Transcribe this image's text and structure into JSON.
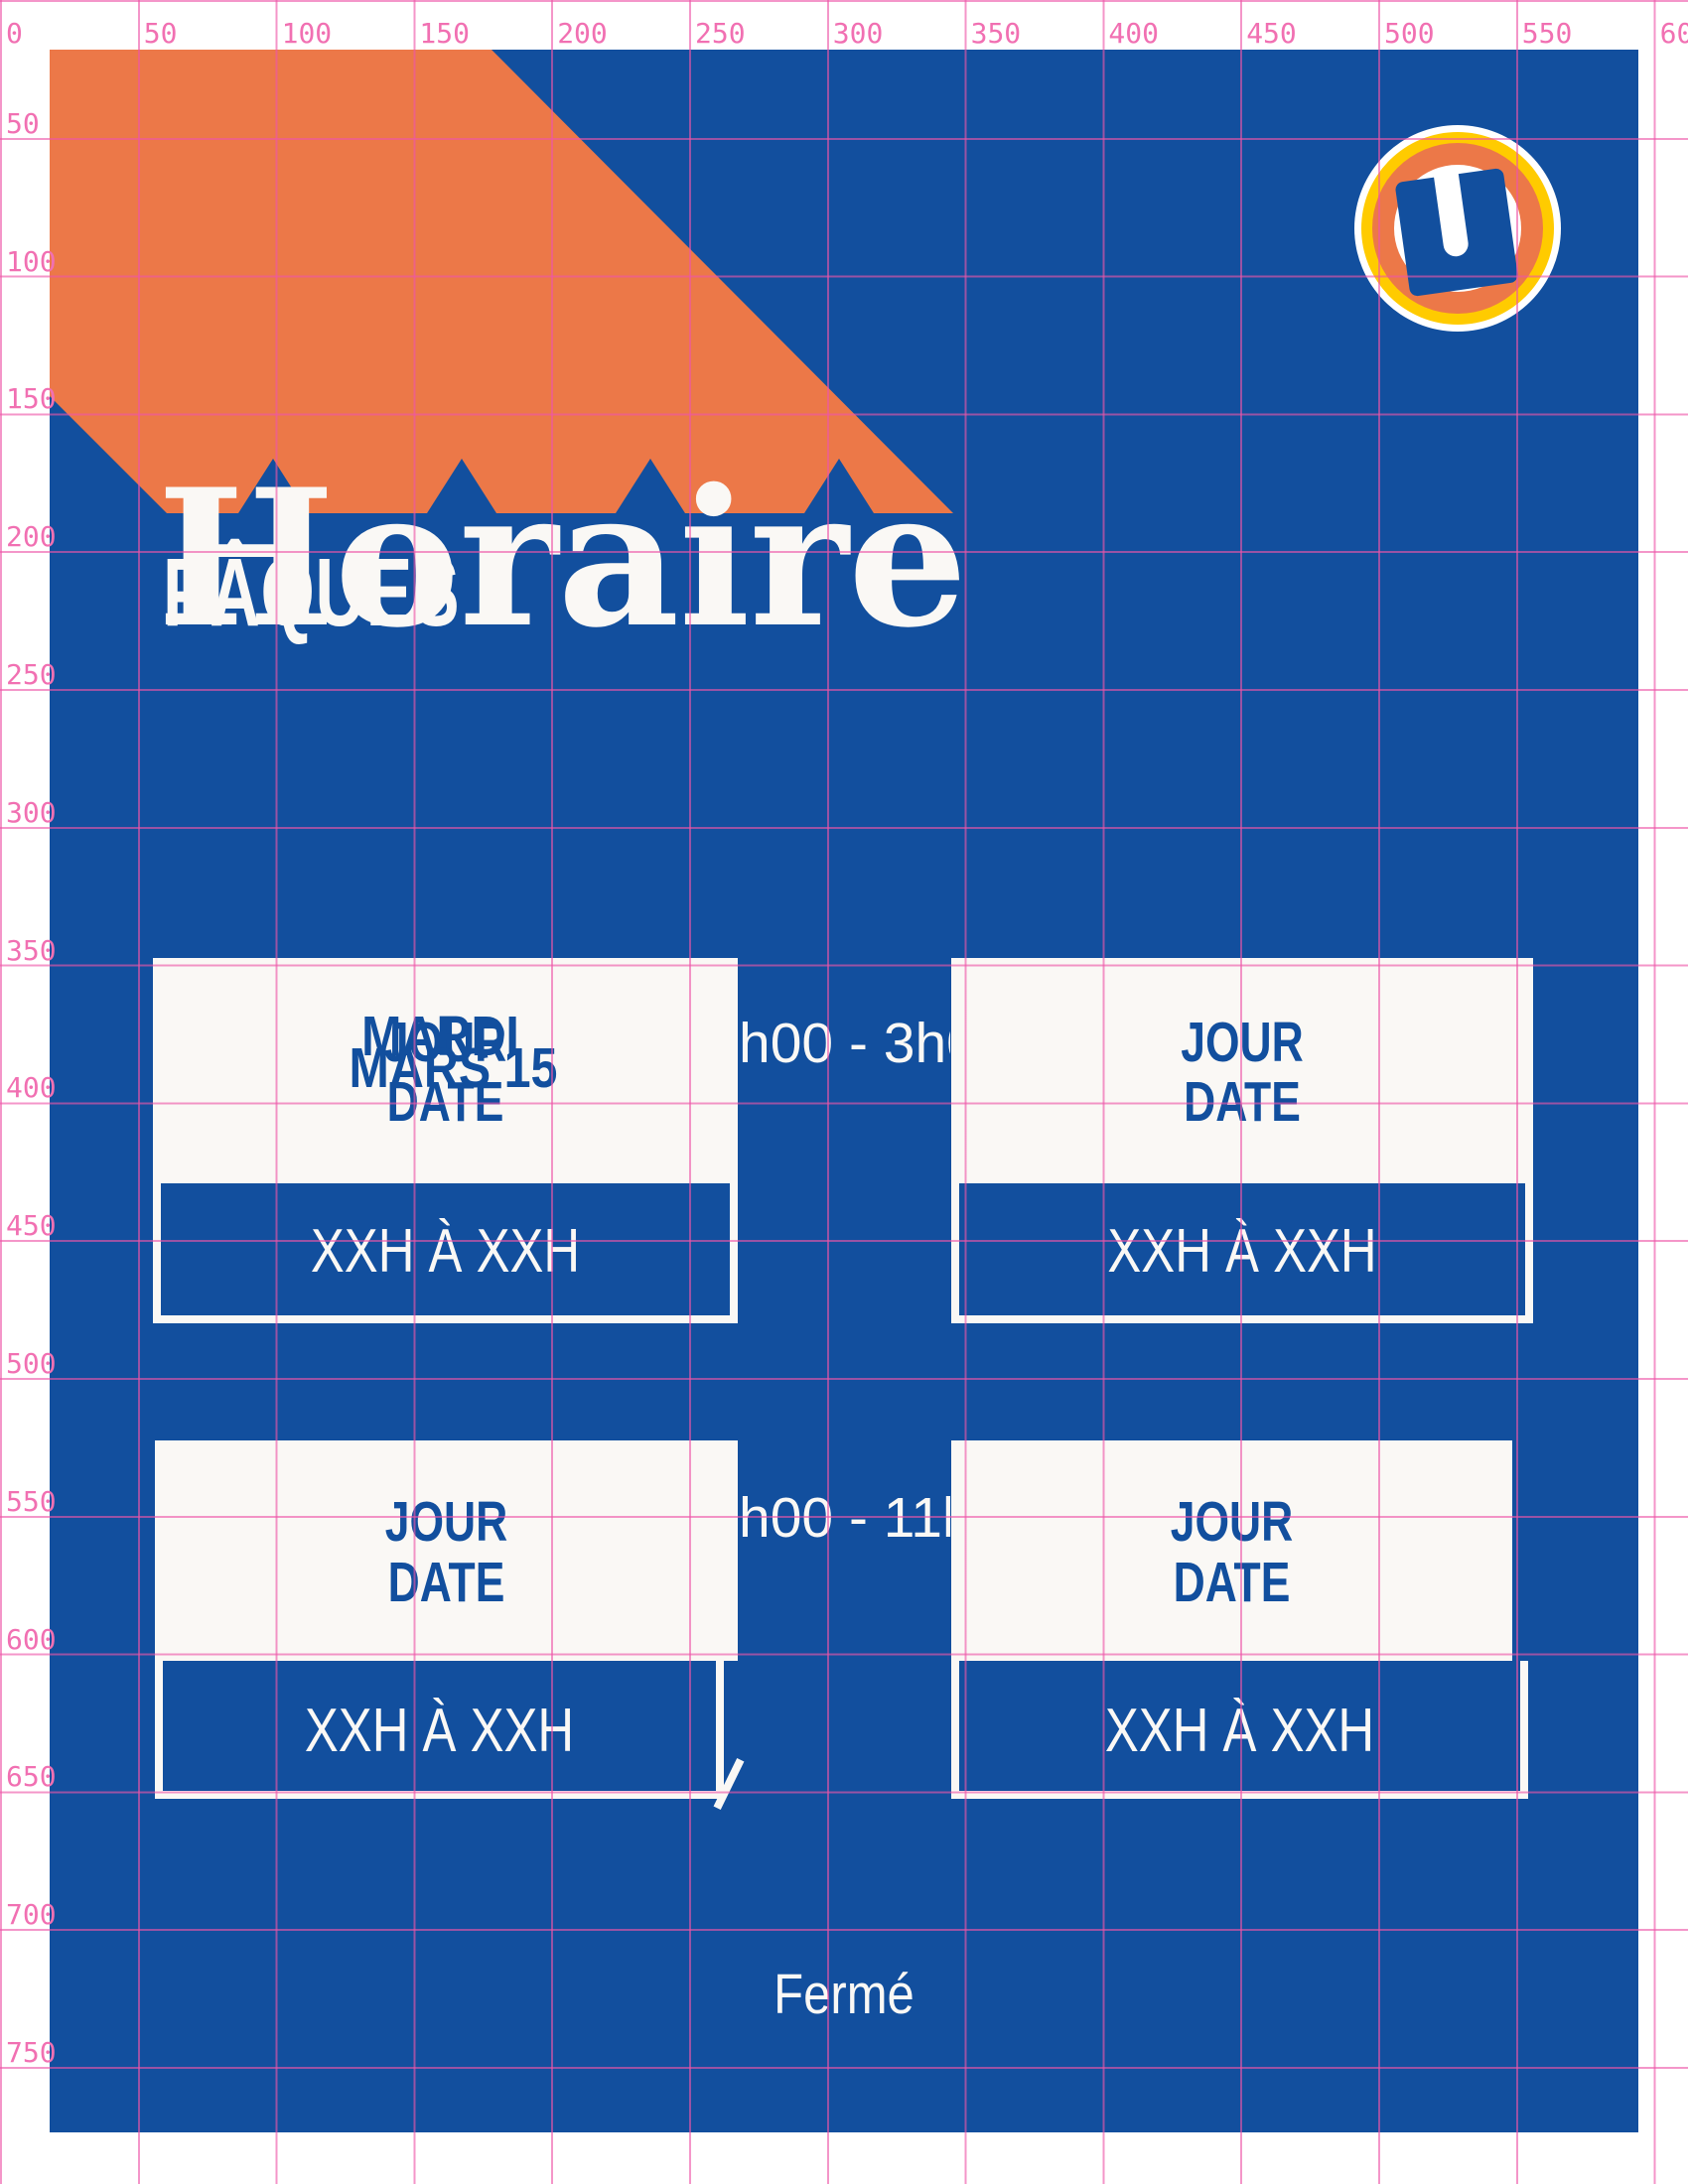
{
  "poster": {
    "title": "Horaire",
    "subtitle": "PÂQUES",
    "closed_label": "Fermé",
    "logo_icon": "u-ring-icon",
    "logo_letter": "U"
  },
  "rulers": {
    "top": [
      "0",
      "50",
      "100",
      "150",
      "200",
      "250",
      "300",
      "350",
      "400",
      "450",
      "500",
      "550",
      "600"
    ],
    "left": [
      "50",
      "100",
      "150",
      "200",
      "250",
      "300",
      "350",
      "400",
      "450",
      "500",
      "550",
      "600",
      "650",
      "700",
      "750"
    ]
  },
  "schedule": {
    "rows": [
      {
        "time_fragment": "h00 - 3h0"
      },
      {
        "time_fragment": "h00 - 11h"
      }
    ],
    "boxes": [
      {
        "day": "JOUR",
        "date": "DATE",
        "hours": "XXH À XXH",
        "overlay_day": "MARDI",
        "overlay_date": "MARS 15"
      },
      {
        "day": "JOUR",
        "date": "DATE",
        "hours": "XXH À XXH"
      },
      {
        "day": "JOUR",
        "date": "DATE",
        "hours": "XXH À XXH"
      },
      {
        "day": "JOUR",
        "date": "DATE",
        "hours": "XXH À XXH"
      }
    ]
  },
  "colors": {
    "poster_blue": "#124F9E",
    "accent_orange": "#EC7848",
    "logo_yellow": "#FFCB00",
    "grid_pink": "#EE55A8",
    "ruler_text_pink": "#F170B2",
    "poster_white": "#FAF8F5"
  }
}
